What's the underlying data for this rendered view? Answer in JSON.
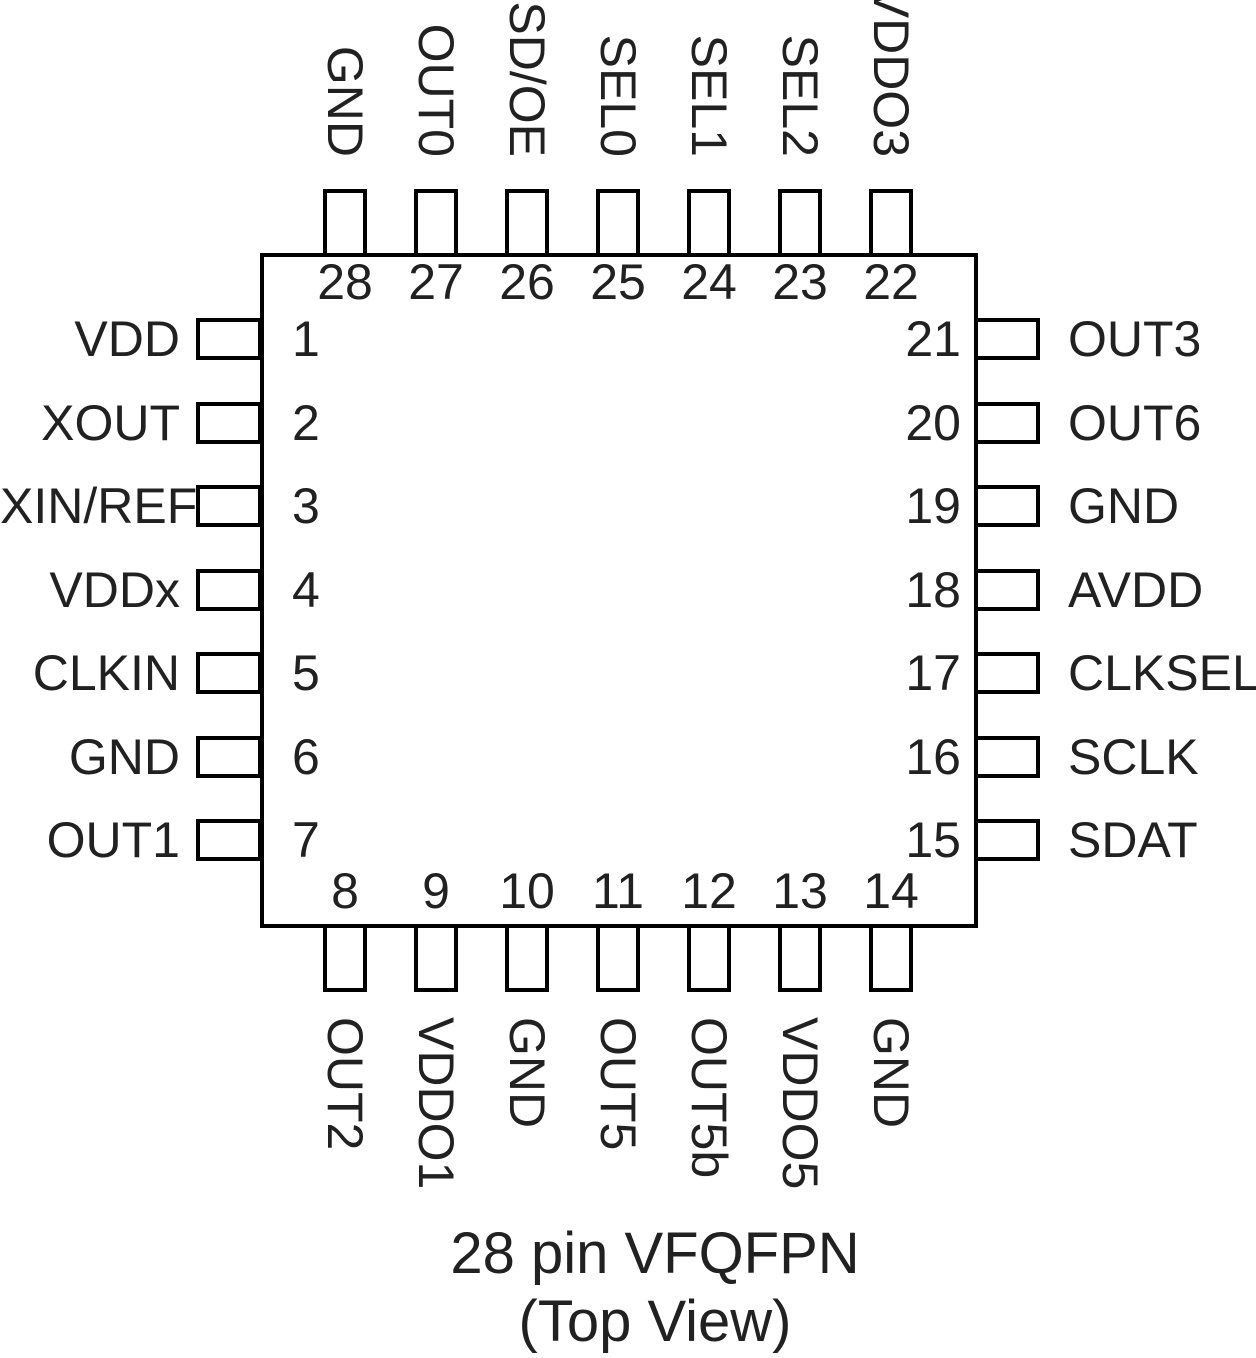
{
  "caption": {
    "line1": "28 pin VFQFPN",
    "line2": "(Top View)"
  },
  "pins": {
    "top": [
      {
        "num": "28",
        "label": "GND"
      },
      {
        "num": "27",
        "label": "OUT0"
      },
      {
        "num": "26",
        "label": "SD/OE"
      },
      {
        "num": "25",
        "label": "SEL0"
      },
      {
        "num": "24",
        "label": "SEL1"
      },
      {
        "num": "23",
        "label": "SEL2"
      },
      {
        "num": "22",
        "label": "VDDO3"
      }
    ],
    "left": [
      {
        "num": "1",
        "label": "VDD"
      },
      {
        "num": "2",
        "label": "XOUT"
      },
      {
        "num": "3",
        "label": "XIN/REF"
      },
      {
        "num": "4",
        "label": "VDDx"
      },
      {
        "num": "5",
        "label": "CLKIN"
      },
      {
        "num": "6",
        "label": "GND"
      },
      {
        "num": "7",
        "label": "OUT1"
      }
    ],
    "right": [
      {
        "num": "21",
        "label": "OUT3"
      },
      {
        "num": "20",
        "label": "OUT6"
      },
      {
        "num": "19",
        "label": "GND"
      },
      {
        "num": "18",
        "label": "AVDD"
      },
      {
        "num": "17",
        "label": "CLKSEL"
      },
      {
        "num": "16",
        "label": "SCLK"
      },
      {
        "num": "15",
        "label": "SDAT"
      }
    ],
    "bottom": [
      {
        "num": "8",
        "label": "OUT2"
      },
      {
        "num": "9",
        "label": "VDDO1"
      },
      {
        "num": "10",
        "label": "GND"
      },
      {
        "num": "11",
        "label": "OUT5"
      },
      {
        "num": "12",
        "label": "OUT5b"
      },
      {
        "num": "13",
        "label": "VDDO5"
      },
      {
        "num": "14",
        "label": "GND"
      }
    ]
  },
  "colors": {
    "line": "#000000",
    "text": "#212121",
    "background": "#ffffff"
  }
}
